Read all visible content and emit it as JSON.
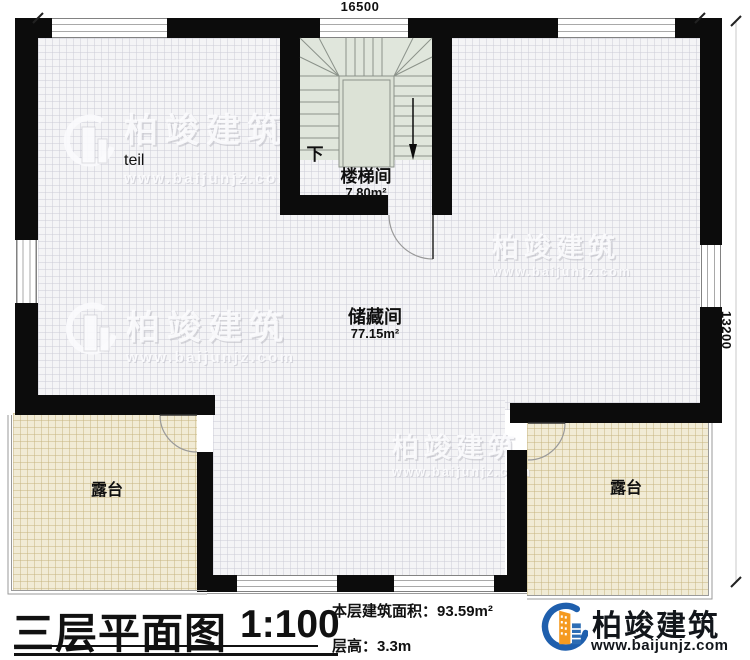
{
  "plan": {
    "dim_top": "16500",
    "dim_right": "13200",
    "stair_room": {
      "label": "楼梯间",
      "area": "7.80m²",
      "down": "下"
    },
    "storage": {
      "label": "储藏间",
      "area": "77.15m²"
    },
    "terrace_left": {
      "label": "露台"
    },
    "terrace_right": {
      "label": "露台"
    }
  },
  "title_block": {
    "title": "三层平面图",
    "scale": "1:100",
    "area_label": "本层建筑面积：",
    "area_value": "93.59m²",
    "height_label": "层高：",
    "height_value": "3.3m"
  },
  "brand": {
    "name": "柏竣建筑",
    "site": "www.baijunjz.com"
  },
  "watermark": {
    "name": "柏竣建筑",
    "site": "www.baijunjz.com"
  },
  "colors": {
    "wall": "#0c0c0c",
    "terrace": "#f1ebd5",
    "stair": "#e0e6dc",
    "brand_blue": "#1f5fad",
    "brand_orange": "#f59a20"
  }
}
